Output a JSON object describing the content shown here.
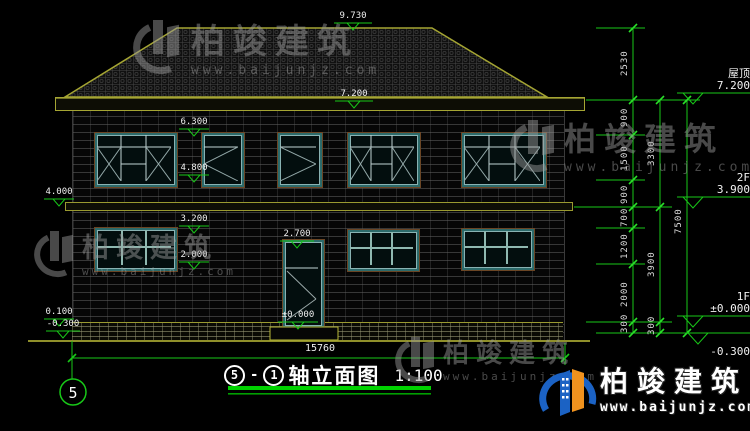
{
  "watermark": {
    "brand": "柏竣建筑",
    "url": "www.baijunjz.com"
  },
  "title": {
    "axis_start": "5",
    "separator": "-",
    "axis_end": "1",
    "name": "轴立面图",
    "scale": "1:100"
  },
  "axis_bubble_label": "5",
  "total_width_dim": "15760",
  "elevations": {
    "ridge": "9.730",
    "eave": "7.200",
    "f2_window_top": "6.300",
    "f2_window_sill": "4.800",
    "belt": "4.000",
    "f1_window_top": "3.200",
    "f1_window_sill": "2.000",
    "door_top": "2.700",
    "door_base": "±0.000",
    "plinth_top": "0.100",
    "ground": "-0.300"
  },
  "right_levels": {
    "roof_label": "屋顶",
    "roof_value": "7.200",
    "f2_label": "2F",
    "f2_value": "3.900",
    "f1_label": "1F",
    "f1_value": "±0.000",
    "ground_value": "-0.300"
  },
  "dim_chains": {
    "inner": [
      "2530",
      "900",
      "1500",
      "900",
      "700",
      "1200",
      "2000",
      "300"
    ],
    "middle": [
      "3300",
      "3900",
      "300"
    ],
    "outer": [
      "7500"
    ]
  }
}
